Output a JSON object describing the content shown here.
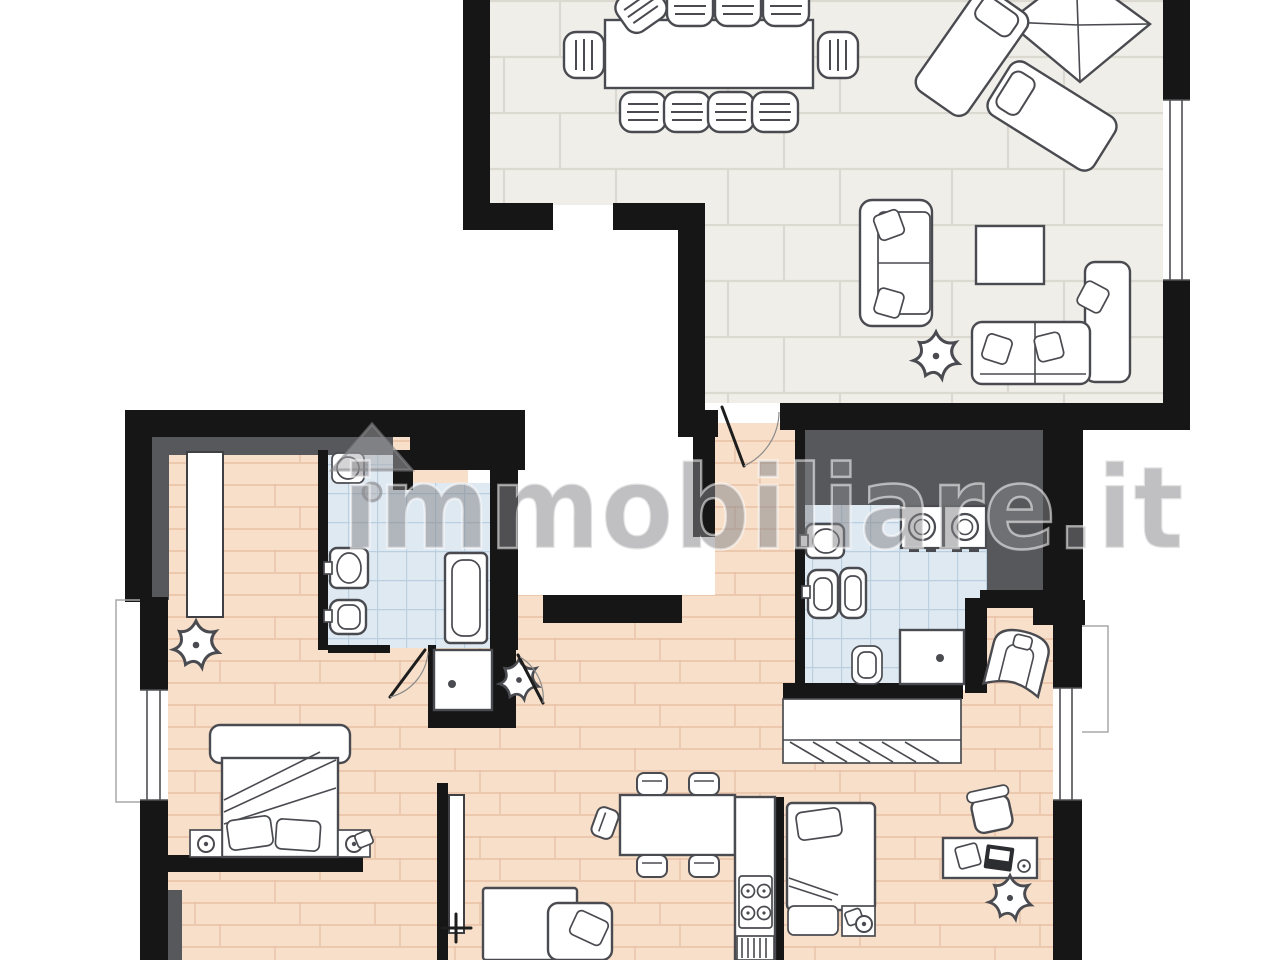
{
  "meta": {
    "type": "real-estate floor plan",
    "description": "Apartment floor plan drawing, top-down, no room labels or dimension text visible"
  },
  "watermark": {
    "text": "immobiliare.it",
    "icon": "house-roof-icon"
  },
  "palette": {
    "background": "#ffffff",
    "wall_black": "#161616",
    "wall_gray_band": "#57585c",
    "tile_floor": "#efeee9",
    "tile_line": "#dcd9d0",
    "wood_floor": "#f7dfc9",
    "wood_line": "#e8c0a6",
    "bath_floor": "#dfe9f2",
    "bath_line": "#bad0e0",
    "furniture_fill": "#ffffff",
    "furniture_line": "#4a4b50",
    "watermark_gray": "#87878b"
  },
  "plan": {
    "rooms": [
      {
        "name": "living-dining-room",
        "floor": "gray-ceramic-tile",
        "furniture": [
          "dining-table",
          "dining-chair x10",
          "sun-umbrella",
          "sun-lounger x2",
          "two-seat-sofa",
          "corner-sofa",
          "coffee-table",
          "plant"
        ]
      },
      {
        "name": "hallway",
        "floor": "wood-parquet",
        "furniture": []
      },
      {
        "name": "bedroom-left",
        "floor": "wood-parquet",
        "furniture": [
          "built-in-wardrobe",
          "double-bed",
          "nightstand-with-lamp x2",
          "plant"
        ]
      },
      {
        "name": "bathroom-left",
        "floor": "light-blue-tile",
        "fixtures": [
          "round-washbasin",
          "wall-sink",
          "toilet",
          "shower-tub",
          "shower-cabin"
        ]
      },
      {
        "name": "bathroom-right",
        "floor": "light-blue-tile",
        "fixtures": [
          "washbasin",
          "bidet",
          "toilet x2",
          "washing-machine x2",
          "shower"
        ]
      },
      {
        "name": "kitchen-living-area",
        "floor": "wood-parquet",
        "furniture": [
          "dining-table",
          "chair x5",
          "kitchen-counter",
          "cooktop-4-burners",
          "kitchen-sink",
          "single-bed",
          "nightstand",
          "bed-partial",
          "plant",
          "interior-door"
        ]
      },
      {
        "name": "bedroom-right",
        "floor": "wood-parquet",
        "furniture": [
          "wardrobe-with-hangers",
          "single-bed",
          "nightstand-with-lamp",
          "desk",
          "laptop",
          "paper-sheet",
          "mouse",
          "office-chair",
          "armchair",
          "plant"
        ]
      }
    ],
    "window_count": 3,
    "door_swings": [
      "living-to-hallway",
      "bathroom-left-cabin-door",
      "nook-door",
      "white-door-leaf"
    ]
  }
}
